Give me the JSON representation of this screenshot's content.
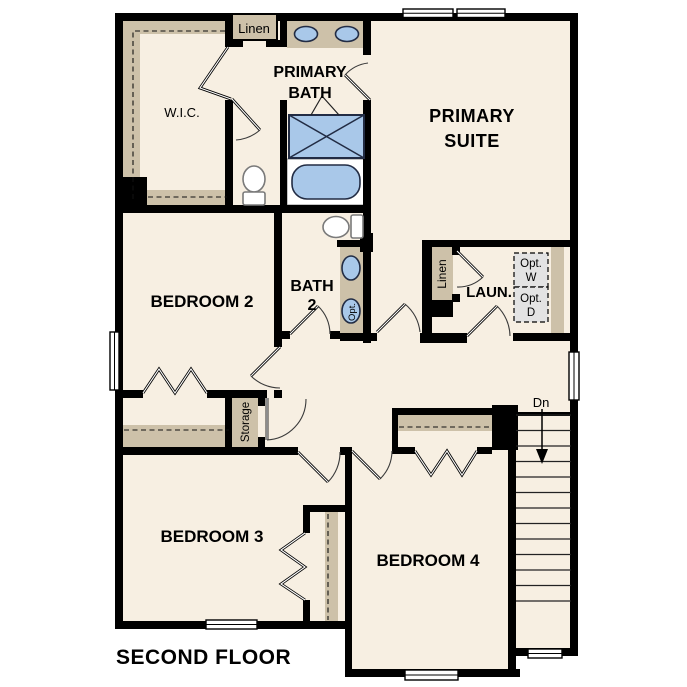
{
  "title": "Second floor plan",
  "colors": {
    "wall": "#000000",
    "floor": "#f7efe2",
    "tan": "#cdc1a9",
    "fixture_blue": "#a9c8e9",
    "fixture_stroke": "#222c44",
    "opt_fill": "#e3e3e3",
    "line_gray": "#3a3a3a",
    "text": "#000000"
  },
  "rooms": {
    "primary_suite": {
      "line1": "PRIMARY",
      "line2": "SUITE"
    },
    "primary_bath": {
      "line1": "PRIMARY",
      "line2": "BATH"
    },
    "wic": {
      "label": "W.I.C."
    },
    "linen_top": {
      "label": "Linen"
    },
    "bedroom2": {
      "label": "BEDROOM 2"
    },
    "bath2": {
      "line1": "BATH",
      "line2": "2",
      "opt_sink_label": "Opt."
    },
    "laundry": {
      "label": "LAUN.",
      "linen_label": "Linen",
      "opt_washer_line1": "Opt.",
      "opt_washer_line2": "W",
      "opt_dryer_line1": "Opt.",
      "opt_dryer_line2": "D"
    },
    "storage": {
      "label": "Storage"
    },
    "bedroom3": {
      "label": "BEDROOM 3"
    },
    "bedroom4": {
      "label": "BEDROOM 4"
    },
    "stairs": {
      "dn_label": "Dn"
    }
  },
  "footer": {
    "label": "SECOND FLOOR"
  }
}
